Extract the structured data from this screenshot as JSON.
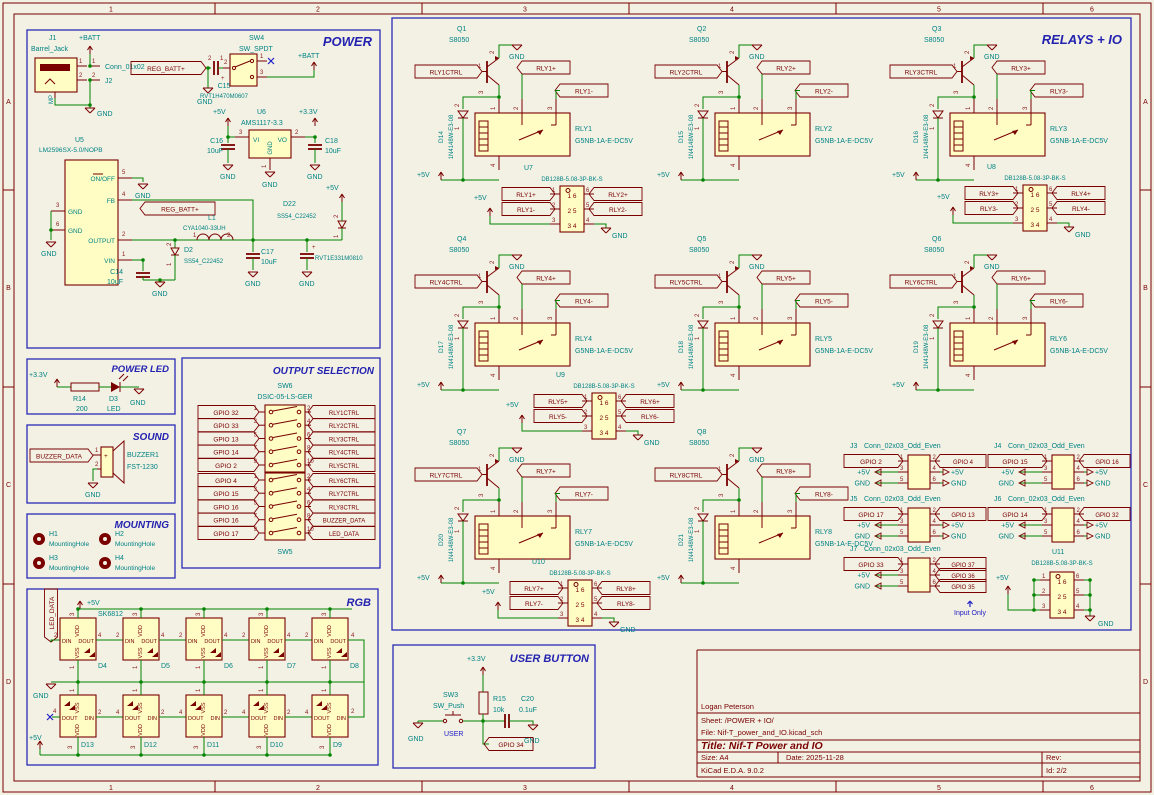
{
  "digits": [
    "1",
    "2",
    "3",
    "4",
    "5",
    "6",
    "7",
    "8",
    "9",
    "10"
  ],
  "colors": {
    "background": "#F3F0E4",
    "outline": "#7A0000",
    "wire": "#008400",
    "field_text": "#008484",
    "section_title": "#2323B0",
    "body_fill": "#FFFCC4"
  },
  "frame": {
    "columns": [
      "1",
      "2",
      "3",
      "4",
      "5",
      "6"
    ],
    "rows": [
      "A",
      "B",
      "C",
      "D"
    ]
  },
  "title_block": {
    "author": "Logan Peterson",
    "sheet": "Sheet: /POWER + IO/",
    "file": "File: Nif-T_power_and_IO.kicad_sch",
    "title": "Title: Nif-T Power and IO",
    "size": "Size: A4",
    "date": "Date: 2025-11-28",
    "rev": "Rev:",
    "app": "KiCad E.D.A. 9.0.2",
    "id": "Id: 2/2"
  },
  "power": {
    "title": "POWER",
    "batt": "+BATT",
    "gnd": "GND",
    "p5v": "+5V",
    "p33v": "+3.3V",
    "reg_batt": "REG_BATT+",
    "plus": "+",
    "j1": {
      "ref": "J1",
      "value": "Barrel_Jack",
      "mp": "MP"
    },
    "j2": {
      "ref": "J2",
      "value": "Conn_01x02"
    },
    "c15": {
      "ref": "C15",
      "value": "RVT1H470M0607"
    },
    "sw4": {
      "ref": "SW4",
      "value": "SW_SPDT"
    },
    "u6": {
      "ref": "U6",
      "value": "AMS1117-3.3",
      "vi": "VI",
      "vo": "VO",
      "gnd": "GND"
    },
    "c16": {
      "ref": "C16",
      "value": "10uF"
    },
    "c18": {
      "ref": "C18",
      "value": "10uF"
    },
    "u5": {
      "ref": "U5",
      "value": "LM2596SX-5.0/NOPB",
      "onoff": "ON/OFF",
      "fb": "FB",
      "gnd": "GND",
      "output": "OUTPUT",
      "vin": "VIN"
    },
    "l1": {
      "ref": "L1",
      "value": "CYA1040-33UH"
    },
    "d2": {
      "ref": "D2",
      "value": "SS54_C22452"
    },
    "d22": {
      "ref": "D22",
      "value": "SS54_C22452"
    },
    "c14": {
      "ref": "C14",
      "value": "10uF"
    },
    "c17": {
      "ref": "C17",
      "value": "10uF"
    },
    "cbulk": {
      "value": "RVT1E331M0810"
    }
  },
  "power_led": {
    "title": "POWER LED",
    "v": "+3.3V",
    "gnd": "GND",
    "r14": {
      "ref": "R14",
      "value": "200"
    },
    "d3": {
      "ref": "D3",
      "value": "LED"
    }
  },
  "sound": {
    "title": "SOUND",
    "label": "BUZZER_DATA",
    "gnd": "GND",
    "buzzer": {
      "ref": "BUZZER1",
      "value": "FST-1230",
      "plus": "+"
    }
  },
  "mounting": {
    "title": "MOUNTING",
    "holes": [
      {
        "ref": "H1",
        "value": "MountingHole"
      },
      {
        "ref": "H2",
        "value": "MountingHole"
      },
      {
        "ref": "H3",
        "value": "MountingHole"
      },
      {
        "ref": "H4",
        "value": "MountingHole"
      }
    ]
  },
  "output_selection": {
    "title": "OUTPUT SELECTION",
    "sw6": {
      "ref": "SW6",
      "value": "DSIC-05-LS-GER"
    },
    "sw5": {
      "ref": "SW5"
    },
    "rows_top": [
      {
        "left": "GPIO 32",
        "right": "RLY1CTRL"
      },
      {
        "left": "GPIO 33",
        "right": "RLY2CTRL"
      },
      {
        "left": "GPIO 13",
        "right": "RLY3CTRL"
      },
      {
        "left": "GPIO 14",
        "right": "RLY4CTRL"
      },
      {
        "left": "GPIO 2",
        "right": "RLY5CTRL"
      }
    ],
    "rows_bottom": [
      {
        "left": "GPIO 4",
        "right": "RLY6CTRL"
      },
      {
        "left": "GPIO 15",
        "right": "RLY7CTRL"
      },
      {
        "left": "GPIO 16",
        "right": "RLY8CTRL"
      },
      {
        "left": "GPIO 16",
        "right": "BUZZER_DATA"
      },
      {
        "left": "GPIO 17",
        "right": "LED_DATA"
      }
    ]
  },
  "rgb": {
    "title": "RGB",
    "part": "SK6812",
    "data_label": "LED_DATA",
    "p5v": "+5V",
    "gnd": "GND",
    "pin_names": {
      "din": "DIN",
      "dout": "DOUT",
      "vdd": "VDD",
      "vss": "VSS"
    },
    "top_refs": [
      "D4",
      "D5",
      "D6",
      "D7",
      "D8"
    ],
    "bottom_refs": [
      "D13",
      "D12",
      "D11",
      "D10",
      "D9"
    ]
  },
  "user_button": {
    "title": "USER BUTTON",
    "v": "+3.3V",
    "gnd": "GND",
    "net": "USER",
    "gpio": "GPIO 34",
    "sw3": {
      "ref": "SW3",
      "value": "SW_Push"
    },
    "r15": {
      "ref": "R15",
      "value": "10k"
    },
    "c20": {
      "ref": "C20",
      "value": "0.1uF"
    }
  },
  "relays": {
    "title": "RELAYS + IO",
    "gnd": "GND",
    "p5v": "+5V",
    "note": "Input Only",
    "pin_rows": [
      "1 6",
      "2 5",
      "3 4"
    ],
    "blocks": [
      {
        "q": "Q1",
        "qv": "S8050",
        "ctrl": "RLY1CTRL",
        "d": "D14",
        "dv": "1N4148W-E3-08",
        "rly": "RLY1",
        "rlyv": "G5NB-1A-E-DC5V",
        "p": "RLY1+",
        "m": "RLY1-"
      },
      {
        "q": "Q2",
        "qv": "S8050",
        "ctrl": "RLY2CTRL",
        "d": "D15",
        "dv": "1N4148W-E3-08",
        "rly": "RLY2",
        "rlyv": "G5NB-1A-E-DC5V",
        "p": "RLY2+",
        "m": "RLY2-"
      },
      {
        "q": "Q3",
        "qv": "S8050",
        "ctrl": "RLY3CTRL",
        "d": "D16",
        "dv": "1N4148W-E3-08",
        "rly": "RLY3",
        "rlyv": "G5NB-1A-E-DC5V",
        "p": "RLY3+",
        "m": "RLY3-"
      },
      {
        "q": "Q4",
        "qv": "S8050",
        "ctrl": "RLY4CTRL",
        "d": "D17",
        "dv": "1N4148W-E3-08",
        "rly": "RLY4",
        "rlyv": "G5NB-1A-E-DC5V",
        "p": "RLY4+",
        "m": "RLY4-"
      },
      {
        "q": "Q5",
        "qv": "S8050",
        "ctrl": "RLY5CTRL",
        "d": "D18",
        "dv": "1N4148W-E3-08",
        "rly": "RLY5",
        "rlyv": "G5NB-1A-E-DC5V",
        "p": "RLY5+",
        "m": "RLY5-"
      },
      {
        "q": "Q6",
        "qv": "S8050",
        "ctrl": "RLY6CTRL",
        "d": "D19",
        "dv": "1N4148W-E3-08",
        "rly": "RLY6",
        "rlyv": "G5NB-1A-E-DC5V",
        "p": "RLY6+",
        "m": "RLY6-"
      },
      {
        "q": "Q7",
        "qv": "S8050",
        "ctrl": "RLY7CTRL",
        "d": "D20",
        "dv": "1N4148W-E3-08",
        "rly": "RLY7",
        "rlyv": "G5NB-1A-E-DC5V",
        "p": "RLY7+",
        "m": "RLY7-"
      },
      {
        "q": "Q8",
        "qv": "S8050",
        "ctrl": "RLY8CTRL",
        "d": "D21",
        "dv": "1N4148W-E3-08",
        "rly": "RLY8",
        "rlyv": "G5NB-1A-E-DC5V",
        "p": "RLY8+",
        "m": "RLY8-"
      }
    ],
    "conns": [
      {
        "ref": "U7",
        "value": "DB128B-5.08-3P-BK-S",
        "l1": "RLY1+",
        "l2": "RLY1-",
        "r1": "RLY2+",
        "r2": "RLY2-"
      },
      {
        "ref": "U8",
        "value": "DB128B-5.08-3P-BK-S",
        "l1": "RLY3+",
        "l2": "RLY3-",
        "r1": "RLY4+",
        "r2": "RLY4-"
      },
      {
        "ref": "U9",
        "value": "DB128B-5.08-3P-BK-S",
        "l1": "RLY5+",
        "l2": "RLY5-",
        "r1": "RLY6+",
        "r2": "RLY6-"
      },
      {
        "ref": "U10",
        "value": "DB128B-5.08-3P-BK-S",
        "l1": "RLY7+",
        "l2": "RLY7-",
        "r1": "RLY8+",
        "r2": "RLY8-"
      }
    ],
    "u11": {
      "ref": "U11",
      "value": "DB128B-5.08-3P-BK-S"
    },
    "headers": [
      {
        "ref": "J3",
        "value": "Conn_02x03_Odd_Even",
        "left": [
          "GPIO 2",
          "+5V",
          "GND"
        ],
        "right": [
          "GPIO 4",
          "+5V",
          "GND"
        ]
      },
      {
        "ref": "J4",
        "value": "Conn_02x03_Odd_Even",
        "left": [
          "GPIO 15",
          "+5V",
          "GND"
        ],
        "right": [
          "GPIO 16",
          "+5V",
          "GND"
        ]
      },
      {
        "ref": "J5",
        "value": "Conn_02x03_Odd_Even",
        "left": [
          "GPIO 17",
          "+5V",
          "GND"
        ],
        "right": [
          "GPIO 13",
          "+5V",
          "GND"
        ]
      },
      {
        "ref": "J6",
        "value": "Conn_02x03_Odd_Even",
        "left": [
          "GPIO 14",
          "+5V",
          "GND"
        ],
        "right": [
          "GPIO 32",
          "+5V",
          "GND"
        ]
      },
      {
        "ref": "J7",
        "value": "Conn_02x03_Odd_Even",
        "left": [
          "GPIO 33",
          "+5V",
          "GND"
        ],
        "right": [
          "GPIO 37",
          "GPIO 36",
          "GPIO 35"
        ]
      }
    ]
  }
}
